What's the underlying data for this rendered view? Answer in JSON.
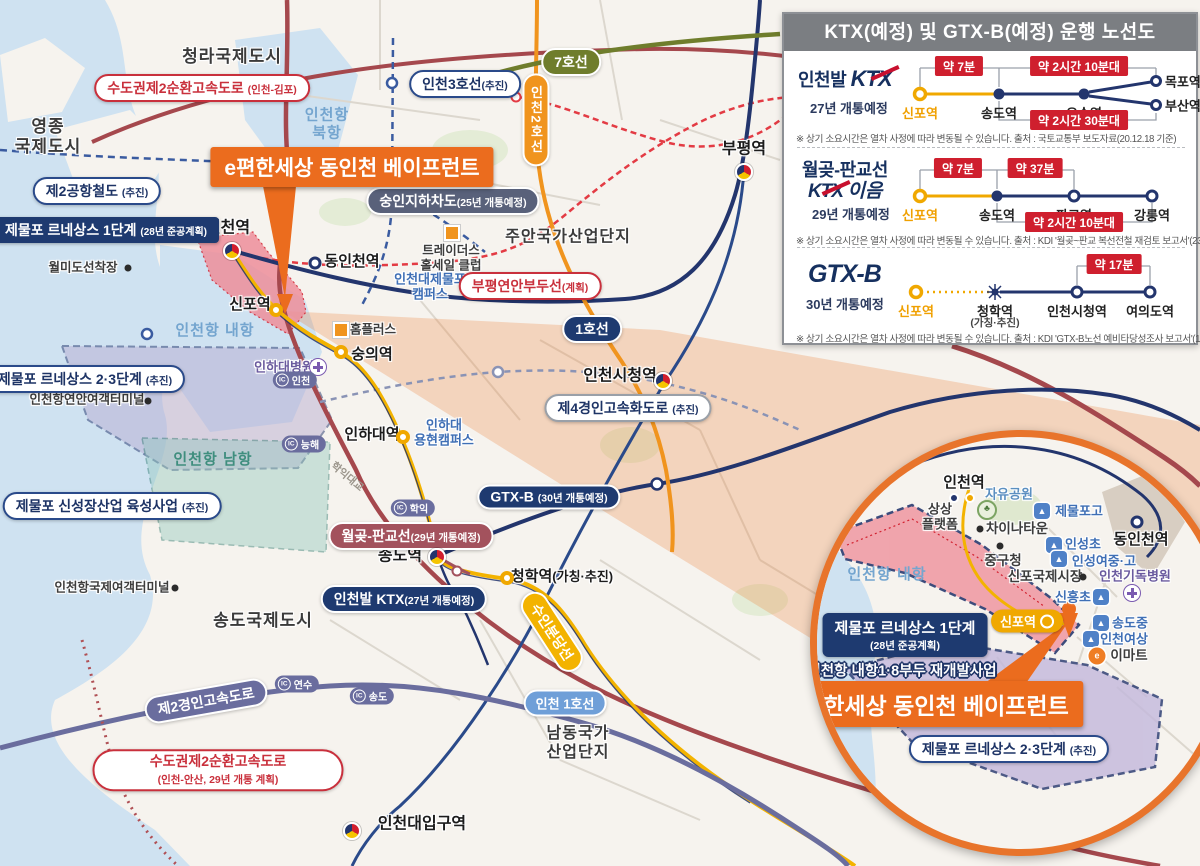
{
  "colors": {
    "accent_orange": "#eb6c1e",
    "navy": "#1e3a70",
    "red_badge": "#cf1f2e",
    "gold": "#f0a800",
    "maroon": "#a3525d",
    "panel_header_gray": "#7b7e82"
  },
  "panel": {
    "title": "KTX(예정) 및 GTX-B(예정) 운행 노선도",
    "sections": [
      {
        "logo_prefix": "인천발",
        "logo_main": "KTX",
        "open_year": "27년 개통예정",
        "stations": [
          "신포역",
          "송도역",
          "오송역",
          "목포역",
          "부산역"
        ],
        "durations": [
          "약 7분",
          "약 2시간 10분대",
          "약 2시간 30분대"
        ],
        "footnote": "※ 상기 소요시간은 열차 사정에 따라 변동될 수 있습니다. 출처 : 국토교통부 보도자료(20.12.18 기준)"
      },
      {
        "logo_prefix": "월곶-판교선",
        "logo_main": "KTX",
        "logo_suffix": "이음",
        "open_year": "29년 개통예정",
        "stations": [
          "신포역",
          "송도역",
          "판교역",
          "강릉역"
        ],
        "durations": [
          "약 7분",
          "약 37분",
          "약 2시간 10분대"
        ],
        "footnote": "※ 상기 소요시간은 열차 사정에 따라 변동될 수 있습니다. 출처 : KDI '월곶~판교 복선전철 재검토 보고서'(23년도)"
      },
      {
        "logo_main": "GTX",
        "logo_suffix": "-B",
        "open_year": "30년 개통예정",
        "stations": [
          "신포역",
          "청학역",
          "인천시청역",
          "여의도역"
        ],
        "station_note": "(가칭·추진)",
        "durations": [
          "약 17분"
        ],
        "footnote": "※ 상기 소요시간은 열차 사정에 따라 변동될 수 있습니다. 출처 : KDI 'GTX-B노선 예비타당성조사 보고서'(19년도)"
      }
    ]
  },
  "map": {
    "cities": {
      "cheongna": "청라국제도시",
      "yeongjong": "영종\n국제도시",
      "juan": "주안국가산업단지",
      "songdo_city": "송도국제도시",
      "namdong": "남동국가\n산업단지"
    },
    "water": {
      "bukhang": "인천항\n북항",
      "naehang": "인천항 내항",
      "namhang": "인천항 남항"
    },
    "stations": {
      "incheon": "인천역",
      "dongincheon": "동인천역",
      "bupyeong": "부평역",
      "sinpo": "신포역",
      "sungui": "숭의역",
      "inha": "인하대역",
      "cityhall": "인천시청역",
      "songdo": "송도역",
      "cheonghak": "청학역",
      "cheonghak_note": "(가칭·추진)",
      "inu": "인천대입구역"
    },
    "lines": {
      "line7": "7호선",
      "incheon2": "인천2호선",
      "incheon3": "인천3호선",
      "incheon3_note": "(추진)",
      "line1": "1호선",
      "incheon_line1": "인천 1호선",
      "suinbundang": "수인분당선",
      "gtxb": "GTX-B",
      "gtxb_note": "(30년 개통예정)",
      "ktx": "인천발 KTX",
      "ktx_note": "(27년 개통예정)",
      "wolpan": "월곶-판교선",
      "wolpan_note": "(29년 개통예정)",
      "airport2": "제2공항철도",
      "airport2_note": "(추진)",
      "bupyeong_pier": "부평연안부두선",
      "bupyeong_pier_note": "(계획)"
    },
    "roads": {
      "sudogwon_gimpo": "수도권제2순환고속도로",
      "sudogwon_gimpo_note": "(인천-김포)",
      "gyeongin2": "제2경인고속도로",
      "gyeongin4": "제4경인고속화도로",
      "gyeongin4_note": "(추진)",
      "sudogwon_ansan": "수도권제2순환고속도로",
      "sudogwon_ansan_note": "(인천-안산, 29년 개통 계획)",
      "sungin": "숭인지하차도",
      "sungin_note": "(25년 개통예정)",
      "hakik_bridge": "학익대교"
    },
    "ic": {
      "label": "IC",
      "incheon": "인천",
      "neunghae": "능해",
      "hakik": "학익",
      "yeonsu": "연수",
      "songdo": "송도"
    },
    "projects": {
      "epyeonhan": "e편한세상 동인천 베이프런트",
      "jemulpo1": "제물포 르네상스 1단계",
      "jemulpo1_note": "(28년 준공계획)",
      "jemulpo23": "제물포 르네상스 2·3단계",
      "jemulpo23_note": "(추진)",
      "sinseongjang": "제물포 신성장산업 육성사업",
      "sinseongjang_note": "(추진)"
    },
    "pois": {
      "wolmido": "월미도선착장",
      "traders": "트레이더스\n홀세일 클럽",
      "inu_campus": "인천대제물포\n캠퍼스",
      "homeplus": "홈플러스",
      "inha_hosp": "인하대병원",
      "inha_campus": "인하대\n용현캠퍼스",
      "yeonan_terminal": "인천항연안여객터미널",
      "intl_terminal": "인천항국제여객터미널"
    }
  },
  "inset": {
    "stations": {
      "incheon": "인천역",
      "dongincheon": "동인천역",
      "sinpo": "신포역"
    },
    "places": {
      "sangsang": "상상\n플랫폼",
      "jayu": "자유공원",
      "jemulpogo": "제물포고",
      "chinatown": "차이나타운",
      "insungcho": "인성초",
      "junggu": "중구청",
      "insungyeo": "인성여중·고",
      "sinpo_market": "신포국제시장",
      "christian_hosp": "인천기독병원",
      "sinheungcho": "신흥초",
      "songdojung": "송도중",
      "yeosang": "인천여상",
      "emart": "이마트",
      "naehang": "인천항 내항"
    },
    "projects": {
      "jemulpo1": "제물포 르네상스 1단계",
      "jemulpo1_note": "(28년 준공계획)",
      "pier18": "인천항 내항1·8부두 재개발사업",
      "epyeonhan": "e편한세상 동인천 베이프런트",
      "jemulpo23": "제물포 르네상스 2·3단계",
      "jemulpo23_note": "(추진)"
    }
  }
}
